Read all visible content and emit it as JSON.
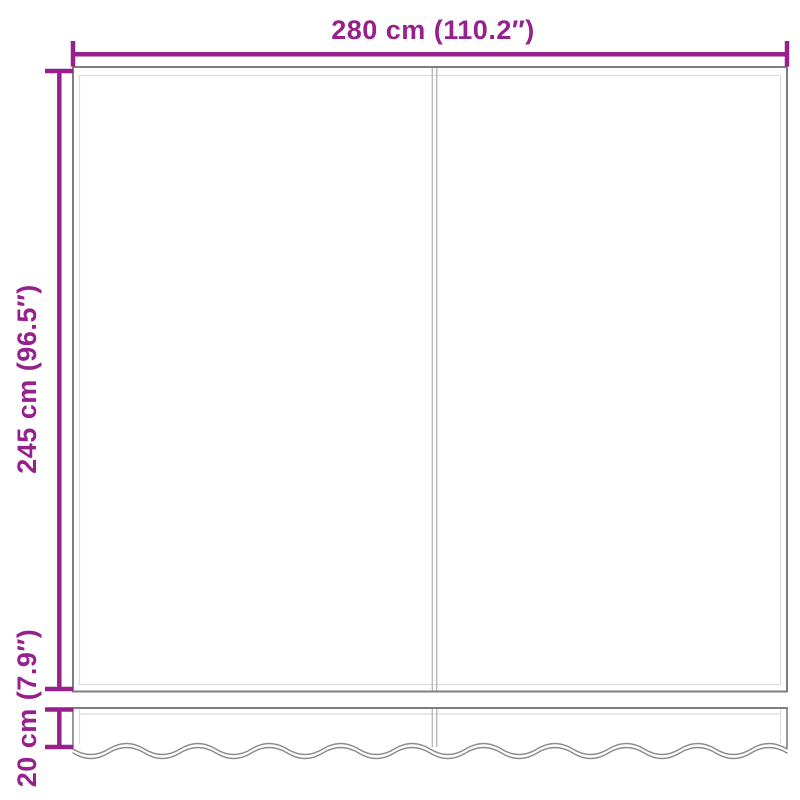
{
  "product_diagram": {
    "type": "awning-replacement-fabric-with-wavy-valance",
    "labels": {
      "width": "280 cm (110.2″)",
      "height": "245 cm (96.5″)",
      "valance_height": "20 cm (7.9″)"
    },
    "values": {
      "width_cm": 280,
      "width_in": 110.2,
      "height_cm": 245,
      "height_in": 96.5,
      "valance_height_cm": 20,
      "valance_height_in": 7.9
    },
    "colors": {
      "dimension": "#96208C",
      "outline": "#7E7E7E",
      "inner_seam": "#DCDCDC",
      "center_seam": "#B9B9B9",
      "wave_edge": "#8C8C8C",
      "background": "#FFFFFF"
    }
  }
}
